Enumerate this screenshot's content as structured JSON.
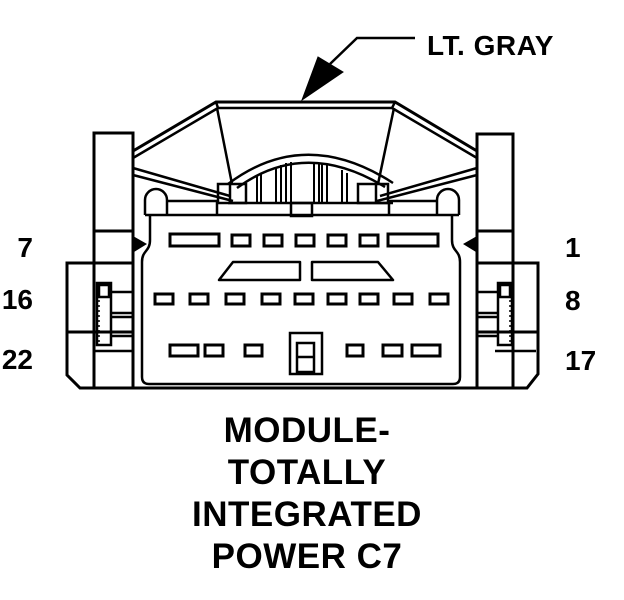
{
  "diagram": {
    "color_callout": "LT. GRAY",
    "caption_lines": [
      "MODULE-",
      "TOTALLY",
      "INTEGRATED",
      "POWER C7"
    ],
    "pin_numbers": {
      "left": [
        "7",
        "16",
        "22"
      ],
      "right": [
        "1",
        "8",
        "17"
      ]
    },
    "colors": {
      "ink": "#000000",
      "background": "#ffffff"
    }
  }
}
